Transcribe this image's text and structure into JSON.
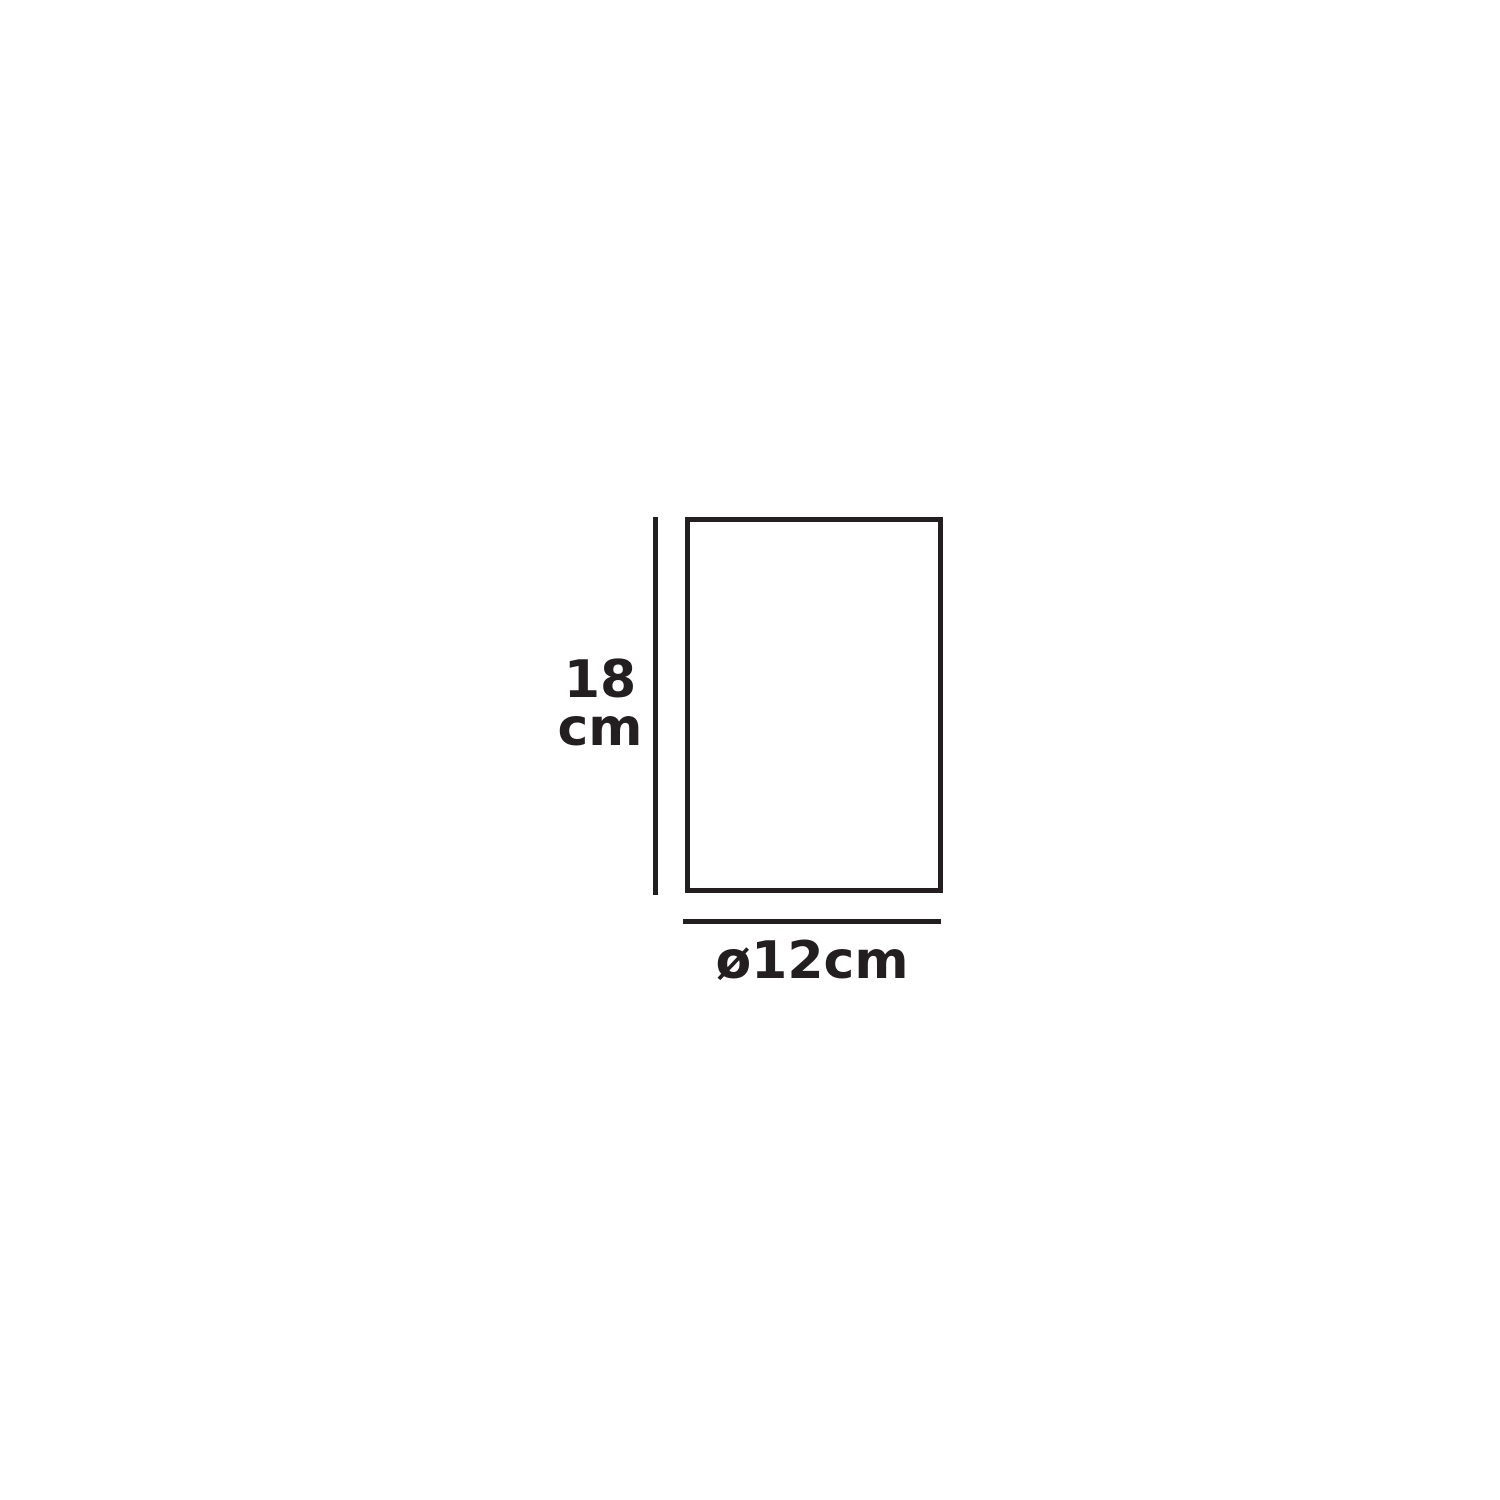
{
  "diagram": {
    "background_color": "#ffffff",
    "ink_color": "#231f20",
    "shape": "rectangle-outline",
    "height_dimension": {
      "value": "18",
      "unit": "cm",
      "label": "18 cm"
    },
    "diameter_dimension": {
      "label": "ø12cm",
      "symbol": "ø",
      "value": "12",
      "unit": "cm"
    }
  }
}
